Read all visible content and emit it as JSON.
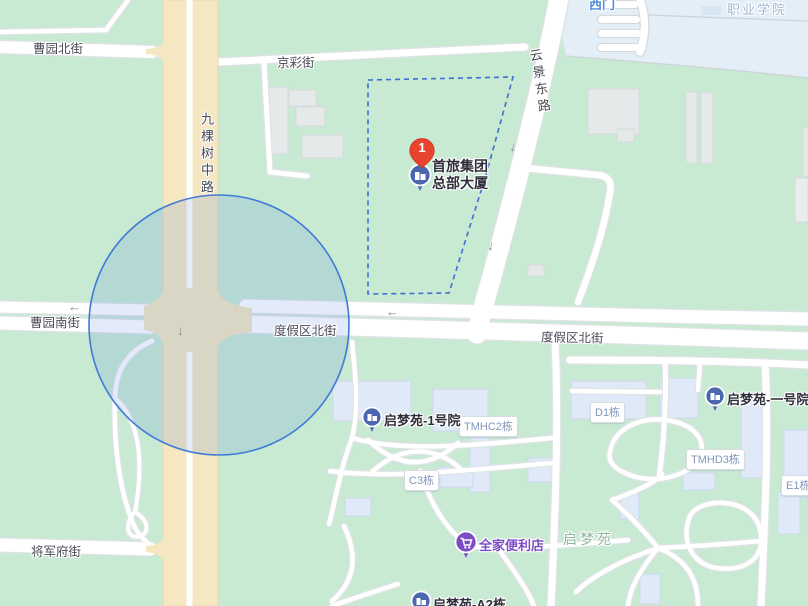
{
  "map_type": "street-map",
  "colors": {
    "land": "#c8e9d2",
    "campus": "#e4eef7",
    "road_major": "#f5e7c1",
    "road_minor": "#ffffff",
    "building_gray": "#e6e9ea",
    "building_blue": "#dfe9f7",
    "selection_circle_stroke": "#3f7ad6",
    "boundary_dash": "#3f6fd1",
    "marker_red": "#e8432f",
    "poi_pin_blue": "#4a67b0",
    "famima_purple": "#7b4cc4"
  },
  "streets": [
    {
      "text": "曹园北街"
    },
    {
      "text": "京彩街"
    },
    {
      "text": "九棵树中路"
    },
    {
      "text": "云景东路"
    },
    {
      "text": "曹园南街"
    },
    {
      "text": "度假区北街"
    },
    {
      "text": "度假区北街"
    },
    {
      "text": "将军府街"
    }
  ],
  "areas": [
    {
      "text": "西门"
    },
    {
      "text": "职业学院"
    },
    {
      "text": "启梦苑"
    }
  ],
  "badges": [
    {
      "text": "TMHC2栋"
    },
    {
      "text": "D1栋"
    },
    {
      "text": "TMHD3栋"
    },
    {
      "text": "C3栋"
    },
    {
      "text": "E1栋"
    }
  ],
  "pois": [
    {
      "text": "启梦苑-1号院"
    },
    {
      "text": "启梦苑-一号院"
    },
    {
      "text": "全家便利店"
    },
    {
      "text": "启梦苑-A2栋"
    }
  ],
  "marker": {
    "number": "1",
    "name_line1": "首旅集团",
    "name_line2": "总部大厦"
  },
  "glyphs": {
    "arrow_left": "←",
    "arrow_down": "↓"
  }
}
